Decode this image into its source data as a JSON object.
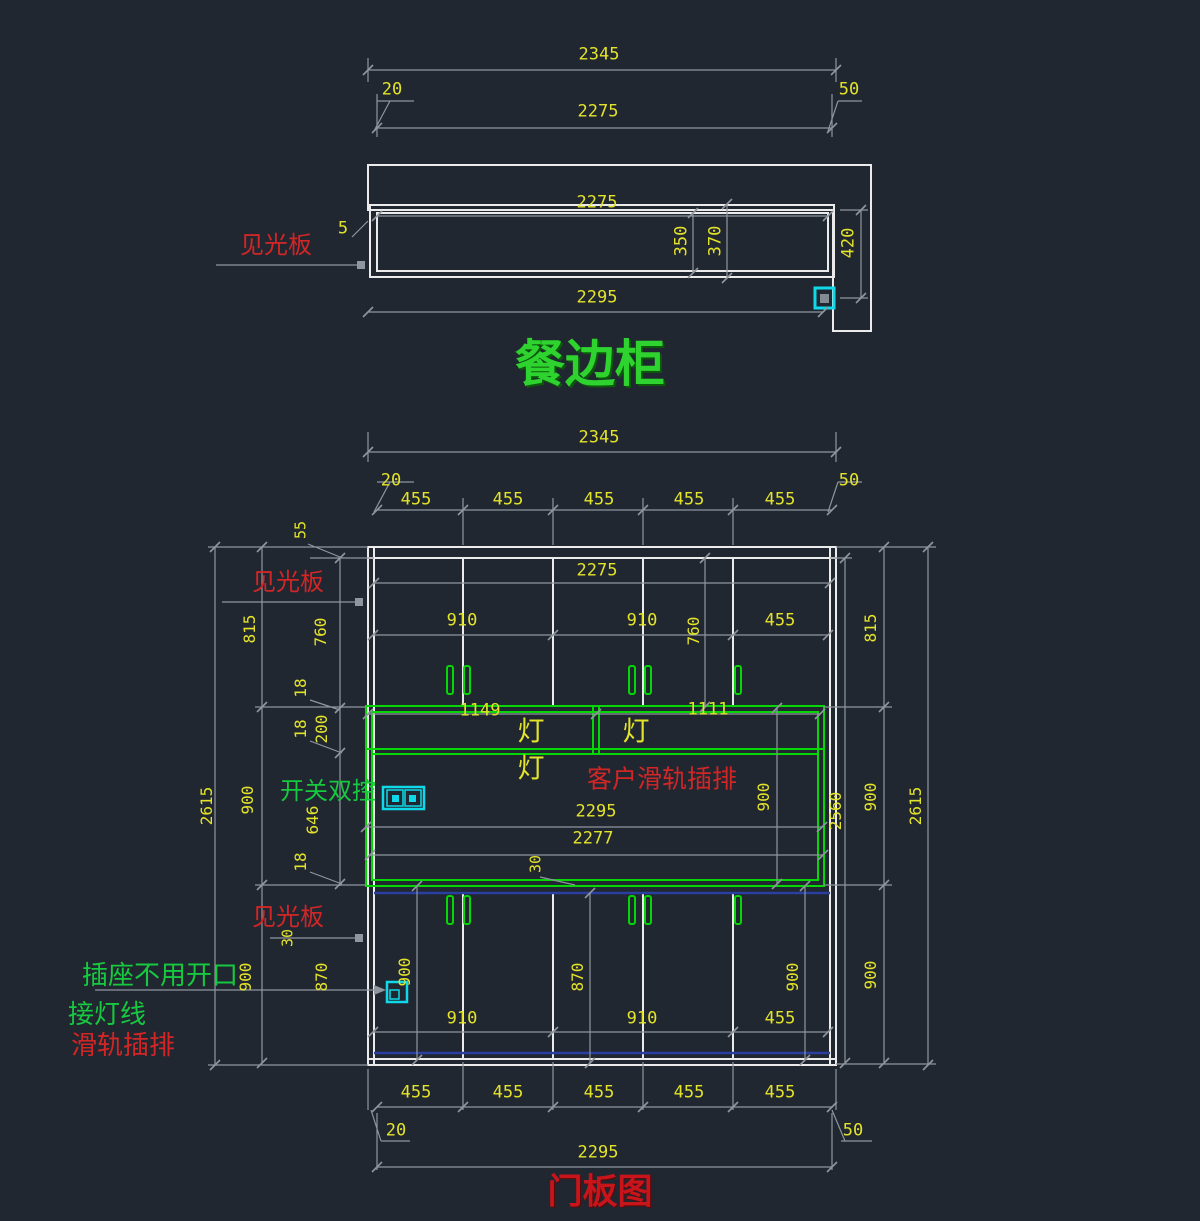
{
  "canvas": {
    "width": 1200,
    "height": 1221
  },
  "colors": {
    "background": "#212731",
    "outline": "#ebebeb",
    "dim_line": "#8f969e",
    "dim_text": "#e3e32a",
    "cabinet_green": "#06d506",
    "label_green": "#16c93f",
    "label_red": "#d22626",
    "title_green": "#2fd32f",
    "title_red": "#c8151b",
    "symbol_cyan": "#0fd8e8",
    "door_blue": "#2b3fa0"
  },
  "views": {
    "plan": {
      "name": "top section view"
    },
    "elevation": {
      "name": "door panel elevation"
    }
  },
  "annotations": [
    {
      "name": "dim-plan-total-width",
      "text": "2345",
      "x": 599,
      "y": 55
    },
    {
      "name": "dim-plan-left-offset",
      "text": "20",
      "x": 392,
      "y": 90
    },
    {
      "name": "dim-plan-inner-width",
      "text": "2275",
      "x": 598,
      "y": 112
    },
    {
      "name": "dim-plan-right-offset",
      "text": "50",
      "x": 849,
      "y": 90
    },
    {
      "name": "dim-plan-cabinet-width",
      "text": "2275",
      "x": 597,
      "y": 203
    },
    {
      "name": "dim-plan-gap-5",
      "text": "5",
      "x": 343,
      "y": 229
    },
    {
      "name": "label-plan-visible-panel",
      "text": "见光板",
      "x": 276,
      "y": 245,
      "cls": "c-red",
      "size": 24
    },
    {
      "name": "dim-plan-depth-350",
      "text": "350",
      "x": 682,
      "y": 241,
      "rot": 1
    },
    {
      "name": "dim-plan-depth-370",
      "text": "370",
      "x": 716,
      "y": 241,
      "rot": 1
    },
    {
      "name": "dim-plan-depth-420",
      "text": "420",
      "x": 849,
      "y": 243,
      "rot": 1
    },
    {
      "name": "dim-plan-bottom-width",
      "text": "2295",
      "x": 597,
      "y": 298
    },
    {
      "name": "plan-title",
      "text": "餐边柜",
      "x": 590,
      "y": 364,
      "cls": "c-title-green",
      "size": 50
    },
    {
      "name": "dim-elev-total-width",
      "text": "2345",
      "x": 599,
      "y": 438
    },
    {
      "name": "dim-elev-left-offset",
      "text": "20",
      "x": 391,
      "y": 481
    },
    {
      "name": "dim-elev-door-width-1",
      "text": "455",
      "x": 416,
      "y": 500
    },
    {
      "name": "dim-elev-door-width-2",
      "text": "455",
      "x": 508,
      "y": 500
    },
    {
      "name": "dim-elev-door-width-3",
      "text": "455",
      "x": 599,
      "y": 500
    },
    {
      "name": "dim-elev-door-width-4",
      "text": "455",
      "x": 689,
      "y": 500
    },
    {
      "name": "dim-elev-door-width-5",
      "text": "455",
      "x": 780,
      "y": 500
    },
    {
      "name": "dim-elev-right-offset",
      "text": "50",
      "x": 849,
      "y": 481
    },
    {
      "name": "dim-elev-top-panel-55",
      "text": "55",
      "x": 301,
      "y": 530,
      "rot": 1,
      "size": 15
    },
    {
      "name": "label-elev-visible-panel-top",
      "text": "见光板",
      "x": 288,
      "y": 582,
      "cls": "c-red",
      "size": 24
    },
    {
      "name": "dim-elev-inner-width",
      "text": "2275",
      "x": 597,
      "y": 571
    },
    {
      "name": "dim-elev-upper-910-a",
      "text": "910",
      "x": 462,
      "y": 621
    },
    {
      "name": "dim-elev-upper-910-b",
      "text": "910",
      "x": 642,
      "y": 621
    },
    {
      "name": "dim-elev-upper-455",
      "text": "455",
      "x": 780,
      "y": 621
    },
    {
      "name": "dim-elev-upper-height-760-left",
      "text": "760",
      "x": 321,
      "y": 632,
      "rot": 1,
      "size": 16
    },
    {
      "name": "dim-elev-section-815-left",
      "text": "815",
      "x": 250,
      "y": 629,
      "rot": 1,
      "size": 16
    },
    {
      "name": "dim-elev-upper-height-760-inner",
      "text": "760",
      "x": 694,
      "y": 631,
      "rot": 1,
      "size": 16
    },
    {
      "name": "dim-elev-section-815-right",
      "text": "815",
      "x": 871,
      "y": 628,
      "rot": 1,
      "size": 16
    },
    {
      "name": "dim-elev-shelf-18-a",
      "text": "18",
      "x": 301,
      "y": 688,
      "rot": 1,
      "size": 16
    },
    {
      "name": "dim-elev-shelf-18-b",
      "text": "18",
      "x": 301,
      "y": 729,
      "rot": 1,
      "size": 16
    },
    {
      "name": "dim-elev-lightstrip-200",
      "text": "200",
      "x": 322,
      "y": 729,
      "rot": 1,
      "size": 16
    },
    {
      "name": "dim-elev-lamp-span-1149",
      "text": "1149",
      "x": 480,
      "y": 711
    },
    {
      "name": "dim-elev-lamp-span-1111",
      "text": "1111",
      "x": 708,
      "y": 710
    },
    {
      "name": "label-lamp-1",
      "text": "灯",
      "x": 531,
      "y": 732,
      "cls": "c-yellow-cjk",
      "size": 27
    },
    {
      "name": "label-lamp-2",
      "text": "灯",
      "x": 636,
      "y": 732,
      "cls": "c-yellow-cjk",
      "size": 27
    },
    {
      "name": "label-lamp-3",
      "text": "灯",
      "x": 531,
      "y": 769,
      "cls": "c-yellow-cjk",
      "size": 27
    },
    {
      "name": "label-client-rail-socket",
      "text": "客户滑轨插排",
      "x": 662,
      "y": 779,
      "cls": "c-red",
      "size": 25
    },
    {
      "name": "label-double-switch",
      "text": "开关双控",
      "x": 328,
      "y": 791,
      "cls": "c-green",
      "size": 24
    },
    {
      "name": "dim-elev-mid-900-left",
      "text": "900",
      "x": 248,
      "y": 800,
      "rot": 1,
      "size": 16
    },
    {
      "name": "dim-elev-mid-900-inner",
      "text": "900",
      "x": 764,
      "y": 797,
      "rot": 1,
      "size": 16
    },
    {
      "name": "dim-elev-mid-900-right",
      "text": "900",
      "x": 871,
      "y": 797,
      "rot": 1,
      "size": 16
    },
    {
      "name": "dim-elev-open-646",
      "text": "646",
      "x": 313,
      "y": 820,
      "rot": 1,
      "size": 16
    },
    {
      "name": "dim-elev-open-width-2295",
      "text": "2295",
      "x": 596,
      "y": 812
    },
    {
      "name": "dim-elev-open-width-2277",
      "text": "2277",
      "x": 593,
      "y": 839
    },
    {
      "name": "dim-elev-gap-30-mid",
      "text": "30",
      "x": 536,
      "y": 864,
      "rot": 1,
      "size": 15
    },
    {
      "name": "dim-elev-inner-height-2560",
      "text": "2560",
      "x": 836,
      "y": 811,
      "rot": 1,
      "size": 16
    },
    {
      "name": "dim-elev-total-height-2615-left",
      "text": "2615",
      "x": 207,
      "y": 806,
      "rot": 1,
      "size": 16
    },
    {
      "name": "dim-elev-total-height-2615-right",
      "text": "2615",
      "x": 916,
      "y": 806,
      "rot": 1,
      "size": 16
    },
    {
      "name": "dim-elev-shelf-18-c",
      "text": "18",
      "x": 301,
      "y": 862,
      "rot": 1,
      "size": 16
    },
    {
      "name": "label-elev-visible-panel-bottom",
      "text": "见光板",
      "x": 288,
      "y": 917,
      "cls": "c-red",
      "size": 24
    },
    {
      "name": "dim-elev-gap-30-bottom",
      "text": "30",
      "x": 288,
      "y": 938,
      "rot": 1,
      "size": 15
    },
    {
      "name": "dim-elev-lower-870-left",
      "text": "870",
      "x": 322,
      "y": 977,
      "rot": 1,
      "size": 16
    },
    {
      "name": "dim-elev-lower-870-mid",
      "text": "870",
      "x": 578,
      "y": 977,
      "rot": 1,
      "size": 16
    },
    {
      "name": "dim-elev-lower-900-outer-left",
      "text": "900",
      "x": 246,
      "y": 977,
      "rot": 1,
      "size": 16
    },
    {
      "name": "dim-elev-lower-900-inner-left",
      "text": "900",
      "x": 405,
      "y": 972,
      "rot": 1,
      "size": 16
    },
    {
      "name": "dim-elev-lower-900-inner-right",
      "text": "900",
      "x": 793,
      "y": 977,
      "rot": 1,
      "size": 16
    },
    {
      "name": "dim-elev-lower-900-outer-right",
      "text": "900",
      "x": 871,
      "y": 975,
      "rot": 1,
      "size": 16
    },
    {
      "name": "dim-elev-lower-910-a",
      "text": "910",
      "x": 462,
      "y": 1019
    },
    {
      "name": "dim-elev-lower-910-b",
      "text": "910",
      "x": 642,
      "y": 1019
    },
    {
      "name": "dim-elev-lower-455",
      "text": "455",
      "x": 780,
      "y": 1019
    },
    {
      "name": "label-socket-no-opening",
      "text": "插座不用开口",
      "x": 160,
      "y": 976,
      "cls": "c-green",
      "size": 26
    },
    {
      "name": "label-lamp-wire",
      "text": "接灯线",
      "x": 107,
      "y": 1015,
      "cls": "c-green",
      "size": 26
    },
    {
      "name": "label-rail-socket",
      "text": "滑轨插排",
      "x": 123,
      "y": 1046,
      "cls": "c-red",
      "size": 26
    },
    {
      "name": "dim-elev-bottom-door-1",
      "text": "455",
      "x": 416,
      "y": 1093
    },
    {
      "name": "dim-elev-bottom-door-2",
      "text": "455",
      "x": 508,
      "y": 1093
    },
    {
      "name": "dim-elev-bottom-door-3",
      "text": "455",
      "x": 599,
      "y": 1093
    },
    {
      "name": "dim-elev-bottom-door-4",
      "text": "455",
      "x": 689,
      "y": 1093
    },
    {
      "name": "dim-elev-bottom-door-5",
      "text": "455",
      "x": 780,
      "y": 1093
    },
    {
      "name": "dim-elev-bottom-left-offset",
      "text": "20",
      "x": 396,
      "y": 1131
    },
    {
      "name": "dim-elev-bottom-right-offset",
      "text": "50",
      "x": 853,
      "y": 1131
    },
    {
      "name": "dim-elev-bottom-width-2295",
      "text": "2295",
      "x": 598,
      "y": 1153
    },
    {
      "name": "elevation-title",
      "text": "门板图",
      "x": 600,
      "y": 1192,
      "cls": "c-title-red",
      "size": 35
    }
  ]
}
